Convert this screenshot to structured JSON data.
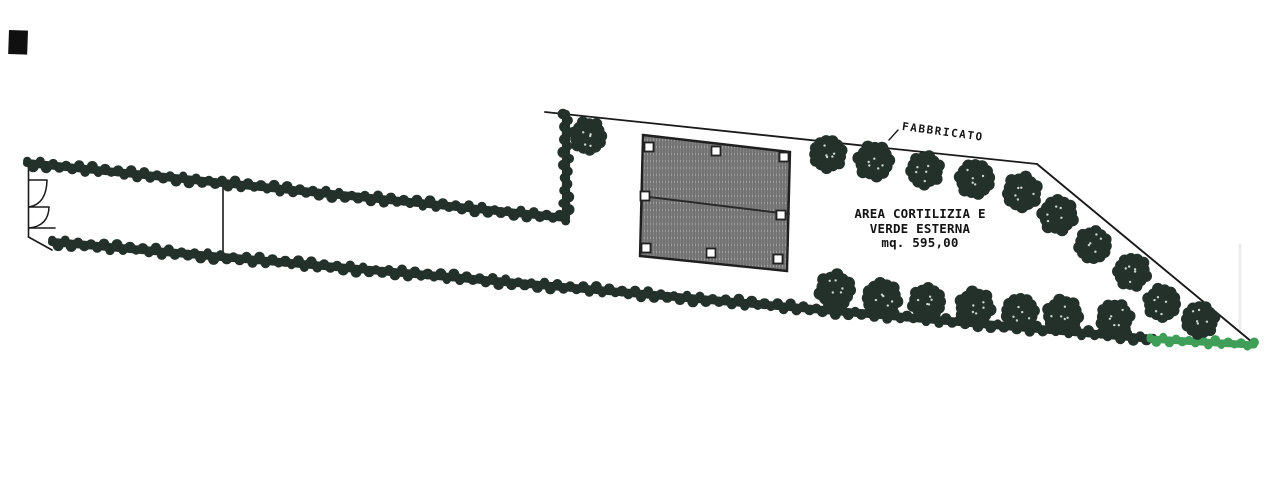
{
  "labels": {
    "fabbricato": "FABBRICATO",
    "area_line1": "AREA CORTILIZIA E",
    "area_line2": "VERDE ESTERNA",
    "area_line3": "mq. 595,00"
  },
  "colors": {
    "paper": "#ffffff",
    "foliage_dark": "#23312a",
    "hedge_green": "#3f9e57",
    "line": "#1a1a1a",
    "hatch_base": "#9c9c9c",
    "hatch_stroke": "#515151",
    "scan_mark": "#101010",
    "scan_streak": "#ececec",
    "speck": "#e8efe9"
  },
  "plan": {
    "hedges": [
      {
        "name": "hedge-top-strip",
        "x1": 27,
        "y1": 163,
        "x2": 566,
        "y2": 218,
        "r": 4.8,
        "color": "foliage_dark"
      },
      {
        "name": "hedge-left-vertical",
        "x1": 566,
        "y1": 216,
        "x2": 566,
        "y2": 114,
        "r": 4.8,
        "color": "foliage_dark"
      },
      {
        "name": "hedge-bottom",
        "x1": 52,
        "y1": 242,
        "x2": 1153,
        "y2": 339,
        "r": 4.8,
        "color": "foliage_dark"
      },
      {
        "name": "hedge-green-corner",
        "x1": 1150,
        "y1": 339,
        "x2": 1254,
        "y2": 345,
        "r": 4.2,
        "color": "hedge_green"
      }
    ],
    "trees": [
      {
        "cx": 588,
        "cy": 136,
        "r": 18
      },
      {
        "cx": 828,
        "cy": 154,
        "r": 18
      },
      {
        "cx": 874,
        "cy": 161,
        "r": 19
      },
      {
        "cx": 925,
        "cy": 170,
        "r": 18
      },
      {
        "cx": 975,
        "cy": 179,
        "r": 19
      },
      {
        "cx": 1022,
        "cy": 192,
        "r": 19
      },
      {
        "cx": 1058,
        "cy": 215,
        "r": 19
      },
      {
        "cx": 1093,
        "cy": 245,
        "r": 18
      },
      {
        "cx": 1132,
        "cy": 272,
        "r": 18
      },
      {
        "cx": 835,
        "cy": 290,
        "r": 19
      },
      {
        "cx": 882,
        "cy": 298,
        "r": 19
      },
      {
        "cx": 927,
        "cy": 302,
        "r": 18
      },
      {
        "cx": 975,
        "cy": 307,
        "r": 19
      },
      {
        "cx": 1020,
        "cy": 312,
        "r": 18
      },
      {
        "cx": 1063,
        "cy": 315,
        "r": 19
      },
      {
        "cx": 1115,
        "cy": 318,
        "r": 18
      },
      {
        "cx": 1162,
        "cy": 303,
        "r": 18
      },
      {
        "cx": 1200,
        "cy": 320,
        "r": 18
      }
    ],
    "building": {
      "outline": [
        [
          643,
          135
        ],
        [
          790,
          152
        ],
        [
          787,
          271
        ],
        [
          640,
          256
        ]
      ],
      "divider": [
        [
          641,
          196
        ],
        [
          789,
          214
        ]
      ],
      "markers": [
        [
          649,
          147
        ],
        [
          716,
          151
        ],
        [
          784,
          157
        ],
        [
          645,
          196
        ],
        [
          781,
          215
        ],
        [
          646,
          248
        ],
        [
          711,
          253
        ],
        [
          778,
          259
        ]
      ],
      "marker_size": 9
    },
    "boundary": {
      "top_line": [
        [
          545,
          112
        ],
        [
          1037,
          164
        ]
      ],
      "right_diagonal": [
        [
          1037,
          164
        ],
        [
          1252,
          342
        ]
      ],
      "tick": [
        [
          889,
          140
        ],
        [
          898,
          130
        ]
      ]
    },
    "entrance": {
      "spine": [
        [
          28.5,
          158
        ],
        [
          28.5,
          237
        ]
      ],
      "chamfer": [
        [
          28.5,
          237
        ],
        [
          52,
          250
        ]
      ],
      "shelves": [
        [
          [
            29,
            180
          ],
          [
            47,
            180
          ]
        ],
        [
          [
            29,
            207
          ],
          [
            49,
            207
          ]
        ],
        [
          [
            29,
            228
          ],
          [
            55,
            228
          ]
        ]
      ],
      "arcs": [
        "M47,180 Q46.5,204 29,207",
        "M49,207 Q48.5,226 29,228"
      ]
    },
    "gate_line": [
      [
        223,
        179
      ],
      [
        223,
        253
      ]
    ],
    "scan_square": {
      "x": 9,
      "y": 30,
      "w": 19,
      "h": 24
    },
    "scan_streak": {
      "x": 1240,
      "y1": 245,
      "y2": 332
    }
  }
}
